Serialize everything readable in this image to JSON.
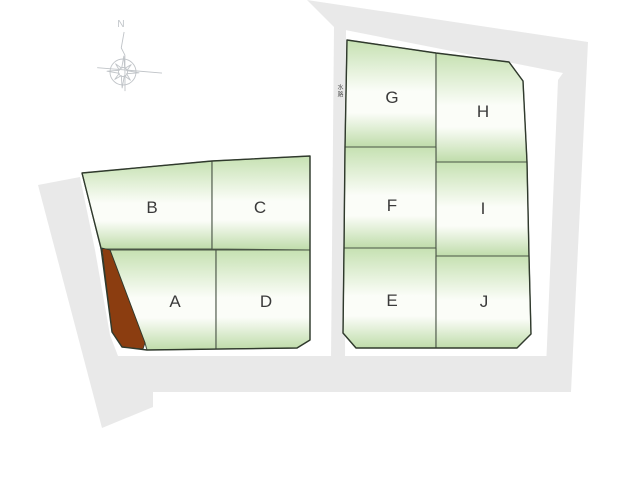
{
  "theme": {
    "road-gray": "#e9e9e9",
    "parcel-green-top": "#c6e1b2",
    "parcel-green-mid": "#fbfdf8",
    "parcel-green-bottom": "#bfdcaa",
    "parcel-stroke": "#4a5546",
    "outline-dark": "#303a2d",
    "label-color": "#3a3a3a",
    "brown": "#8b3d10",
    "compass-gray": "#c0c4c8",
    "tiny-text": "#555555"
  },
  "compass": {
    "north_label": "N"
  },
  "strip_label": {
    "text": "水路"
  },
  "parcels": {
    "left_block": {
      "items": [
        {
          "label": "B"
        },
        {
          "label": "C"
        },
        {
          "label": "A"
        },
        {
          "label": "D"
        }
      ]
    },
    "right_block": {
      "items": [
        {
          "label": "G"
        },
        {
          "label": "H"
        },
        {
          "label": "F"
        },
        {
          "label": "I"
        },
        {
          "label": "E"
        },
        {
          "label": "J"
        }
      ]
    }
  }
}
